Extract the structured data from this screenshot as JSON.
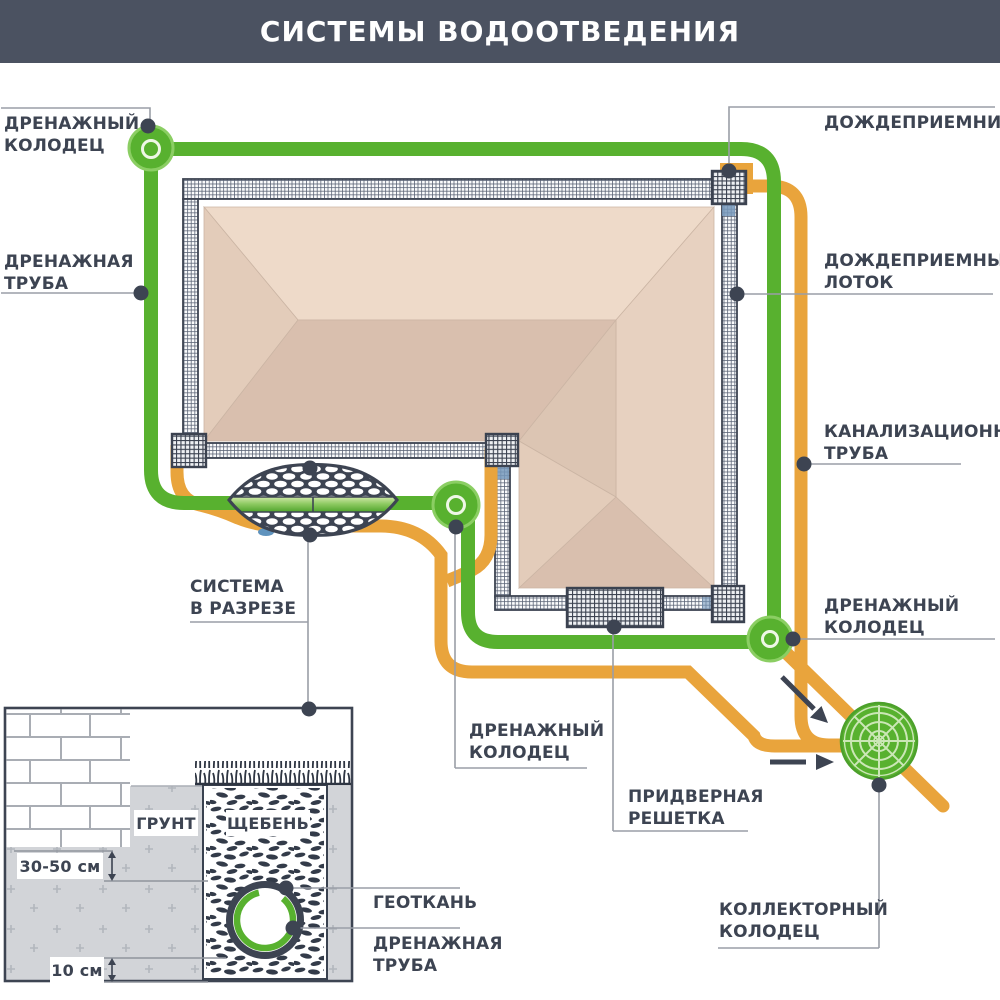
{
  "header": {
    "title": "СИСТЕМЫ ВОДООТВЕДЕНИЯ",
    "bg": "#4b5261"
  },
  "callouts": {
    "drain_well_top": {
      "line1": "ДРЕНАЖНЫЙ",
      "line2": "КОЛОДЕЦ"
    },
    "drain_pipe_left": {
      "line1": "ДРЕНАЖНАЯ",
      "line2": "ТРУБА"
    },
    "rain_inlet": {
      "line1": "ДОЖДЕПРИЕМНИК"
    },
    "rain_tray": {
      "line1": "ДОЖДЕПРИЕМНЫЙ",
      "line2": "ЛОТОК"
    },
    "sewer_pipe": {
      "line1": "КАНАЛИЗАЦИОННАЯ",
      "line2": "ТРУБА"
    },
    "drain_well_right": {
      "line1": "ДРЕНАЖНЫЙ",
      "line2": "КОЛОДЕЦ"
    },
    "section_view": {
      "line1": "СИСТЕМА",
      "line2": "В РАЗРЕЗЕ"
    },
    "drain_well_mid": {
      "line1": "ДРЕНАЖНЫЙ",
      "line2": "КОЛОДЕЦ"
    },
    "door_grate": {
      "line1": "ПРИДВЕРНАЯ",
      "line2": "РЕШЕТКА"
    },
    "collector_well": {
      "line1": "КОЛЛЕКТОРНЫЙ",
      "line2": "КОЛОДЕЦ"
    },
    "geotextile": {
      "line1": "ГЕОТКАНЬ"
    },
    "drain_pipe_section": {
      "line1": "ДРЕНАЖНАЯ",
      "line2": "ТРУБА"
    }
  },
  "section": {
    "soil": "ГРУНТ",
    "gravel": "ЩЕБЕНЬ",
    "depth_upper": "30-50 см",
    "depth_lower": "10 см"
  },
  "colors": {
    "ink": "#3d4452",
    "green_pipe": "#58b12f",
    "orange_pipe": "#e9a43c",
    "roof_light": "#eedac9",
    "roof_dark": "#d9bfae",
    "soil_gray": "#d2d4d8",
    "callout_line": "#9a9ea7",
    "blue_accent": "#6f94b8"
  }
}
